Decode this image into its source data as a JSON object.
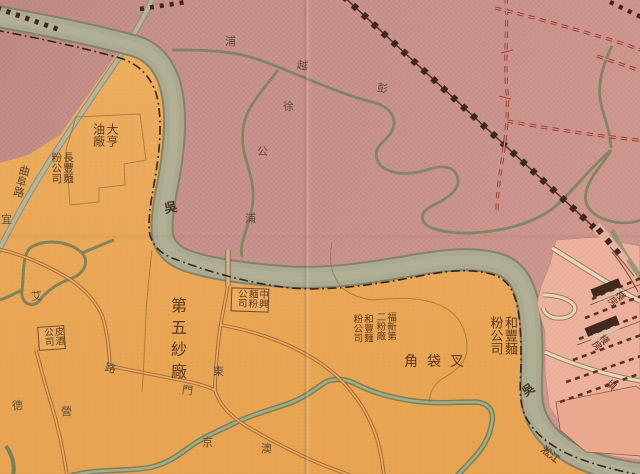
{
  "map_type": "vintage-chinese-city-map",
  "labels": {
    "creek_peng": "彭",
    "creek_yue": "越",
    "creek_pu_top": "浦",
    "creek_xu": "徐",
    "creek_gong": "公",
    "creek_pu_low": "浦",
    "river_wu_1": "吳",
    "river_wu_2": "吳",
    "river_script": "淞江",
    "daheng_oil": "大亨油廠",
    "changfeng_flour": "長豐麵粉公司",
    "beer_co": "皮酒公司",
    "no5_cotton_mill": "第五紗廠",
    "zhongxing_flour": "中興麵粉公司",
    "fuxin_no2_mill": "福新第二粉廠",
    "hefeng_flour_small": "和豐麵粉公司",
    "hefeng_flour": "和豐麵粉公司",
    "chadaijiao": "叉袋角",
    "road_qufu": "曲阜路",
    "road_yi": "宜",
    "road_ai": "艾",
    "road_lu": "路",
    "road_ying": "營",
    "road_de": "德",
    "road_dong": "東",
    "road_men": "門",
    "road_jing": "京",
    "road_ao": "澳",
    "warehouse_1": "棧房",
    "warehouse_2": "棧房",
    "bund": "埧"
  },
  "colors": {
    "north_bank_mauve": "#c7918b",
    "south_bank_orange": "#eaa85a",
    "river_fill": "#abaa90",
    "river_edge": "#83826a",
    "station_pink": "#edb29e",
    "pier_block_pink": "#eaa88f",
    "creek_green": "#7d8560",
    "railway_ink": "#3f281b",
    "red_boundary_dash": "#a63d2b",
    "settlement_dash_dot": "#35261a",
    "label_ink": "#5a3a22",
    "shed_dark": "#43291d"
  }
}
